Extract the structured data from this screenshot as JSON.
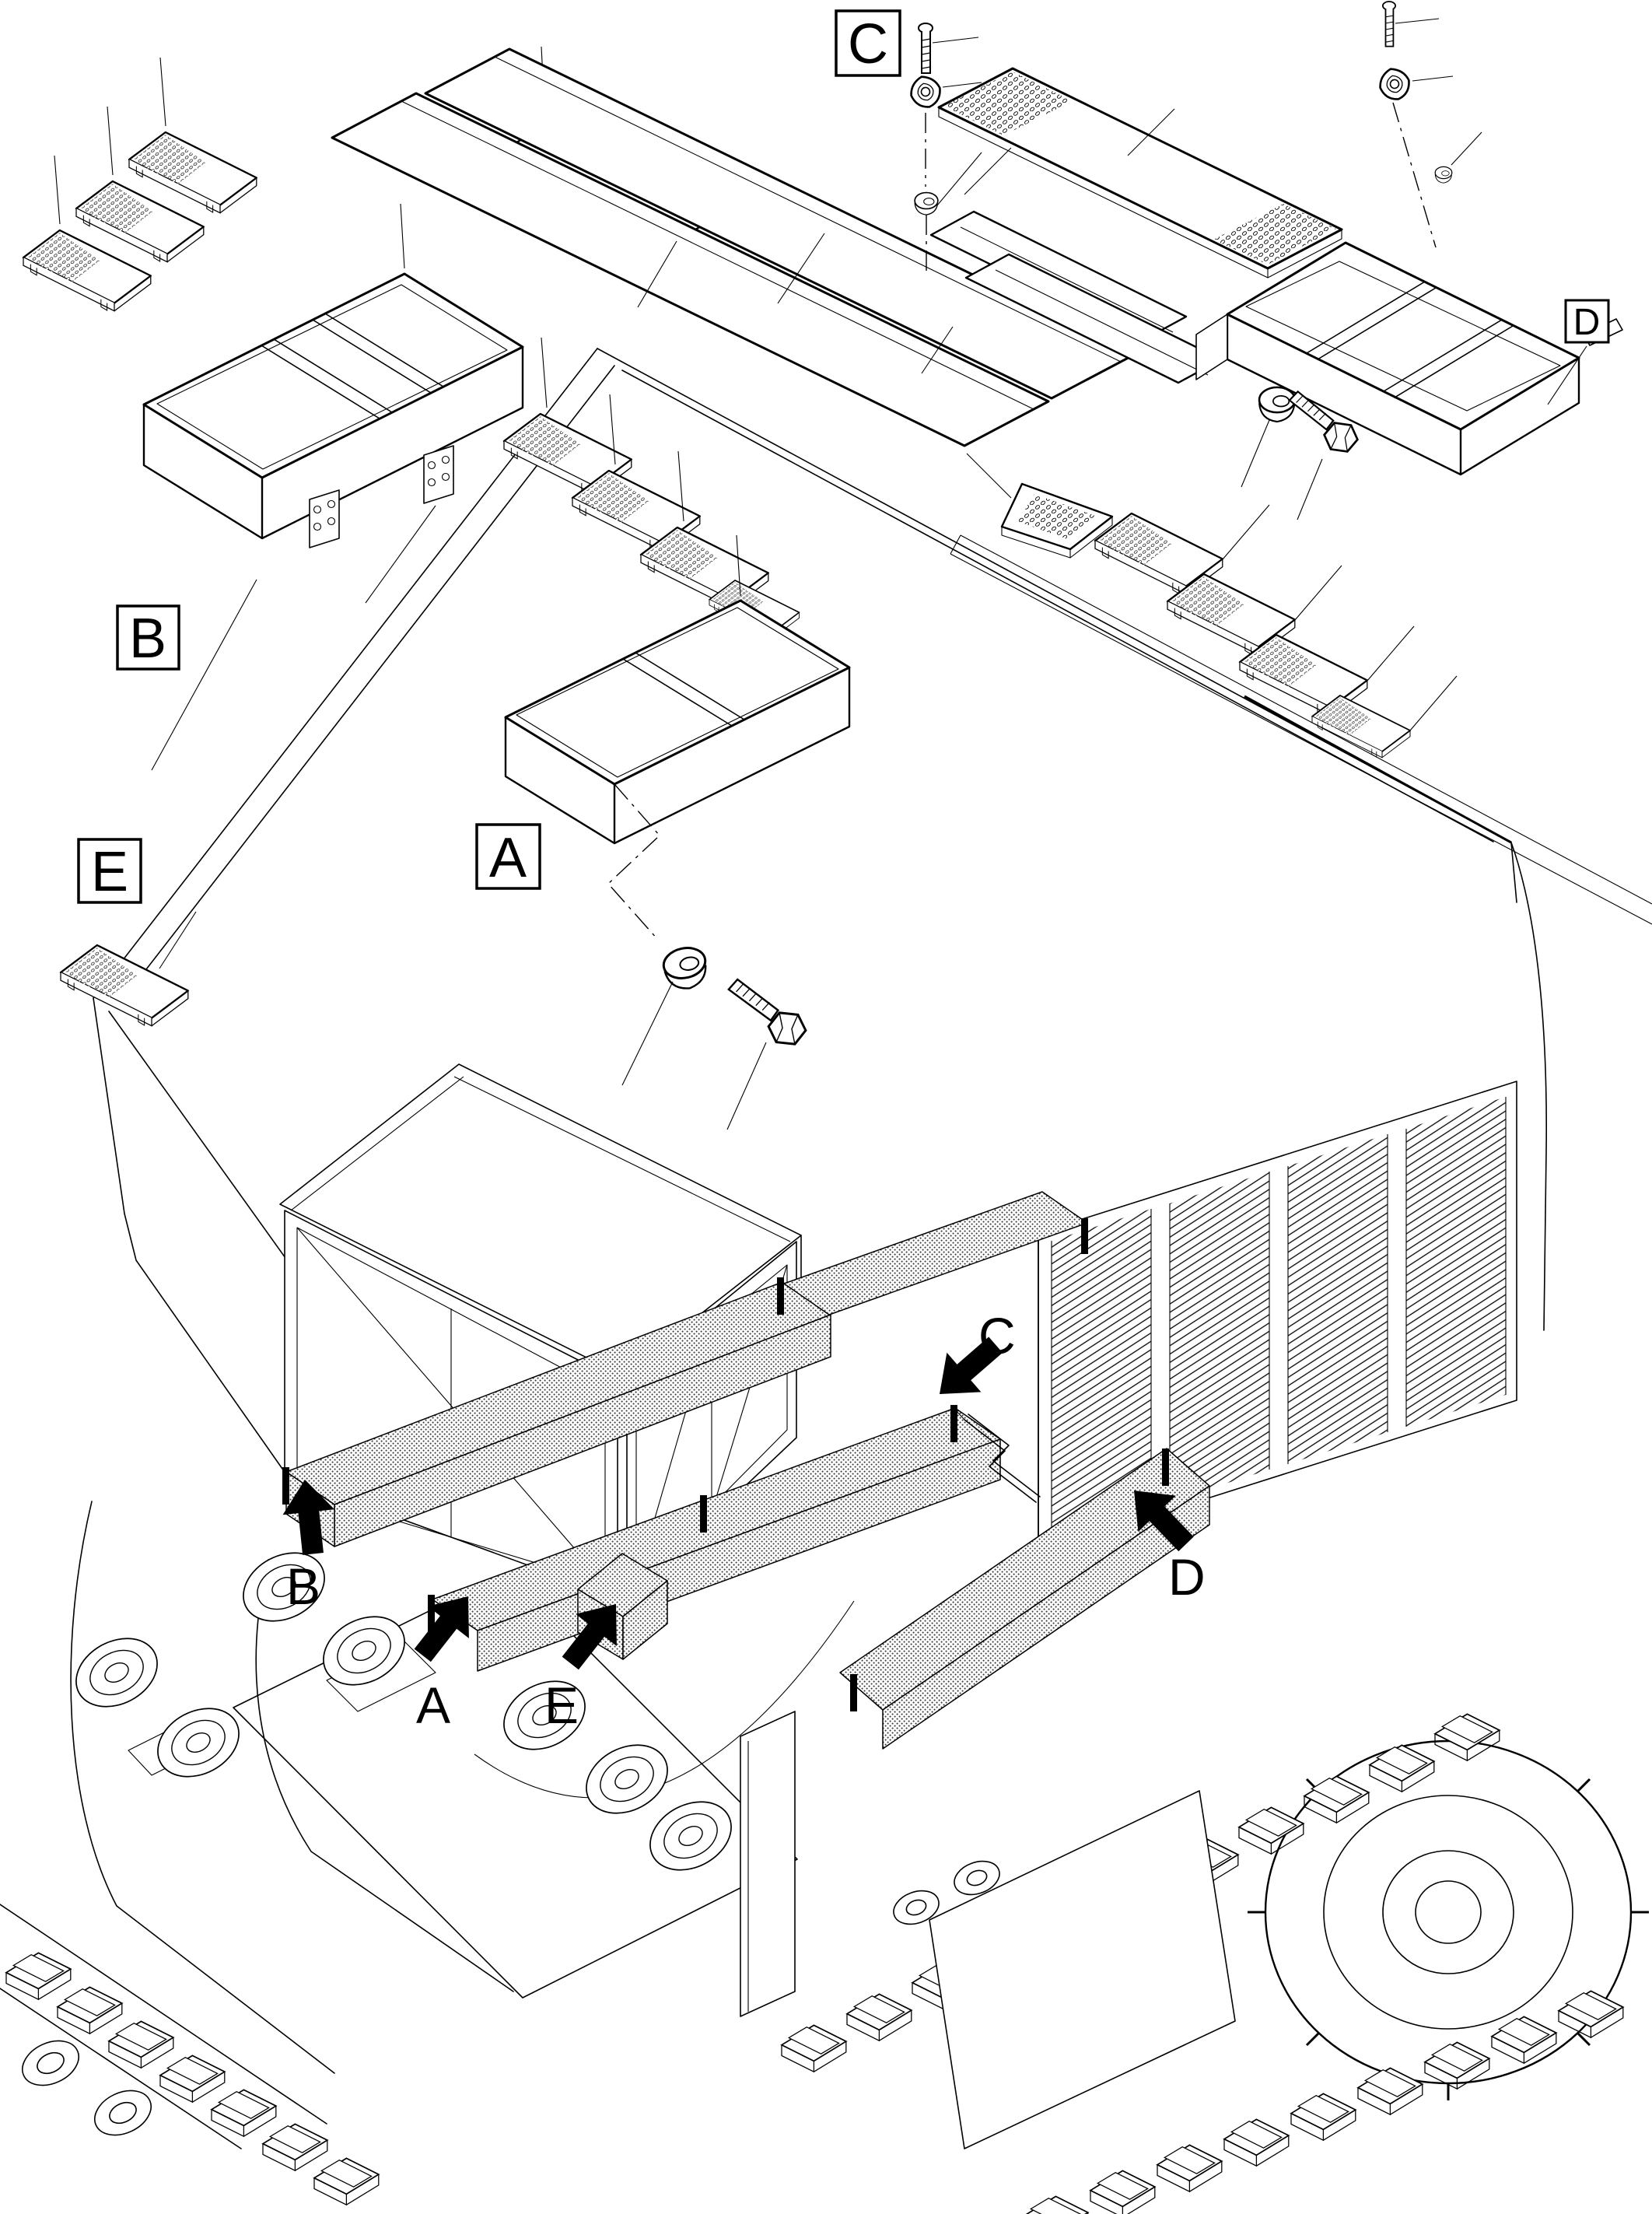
{
  "figure": {
    "background_color": "#ffffff",
    "line_color": "#000000",
    "callout_boxes": [
      {
        "id": "A",
        "label": "A"
      },
      {
        "id": "B",
        "label": "B"
      },
      {
        "id": "C",
        "label": "C"
      },
      {
        "id": "D",
        "label": "D"
      },
      {
        "id": "E",
        "label": "E"
      }
    ],
    "location_arrows": [
      {
        "id": "A",
        "label": "A",
        "direction": "up-right"
      },
      {
        "id": "B",
        "label": "B",
        "direction": "up"
      },
      {
        "id": "C",
        "label": "C",
        "direction": "down-left"
      },
      {
        "id": "D",
        "label": "D",
        "direction": "up-left"
      },
      {
        "id": "E",
        "label": "E",
        "direction": "up-right"
      }
    ]
  }
}
